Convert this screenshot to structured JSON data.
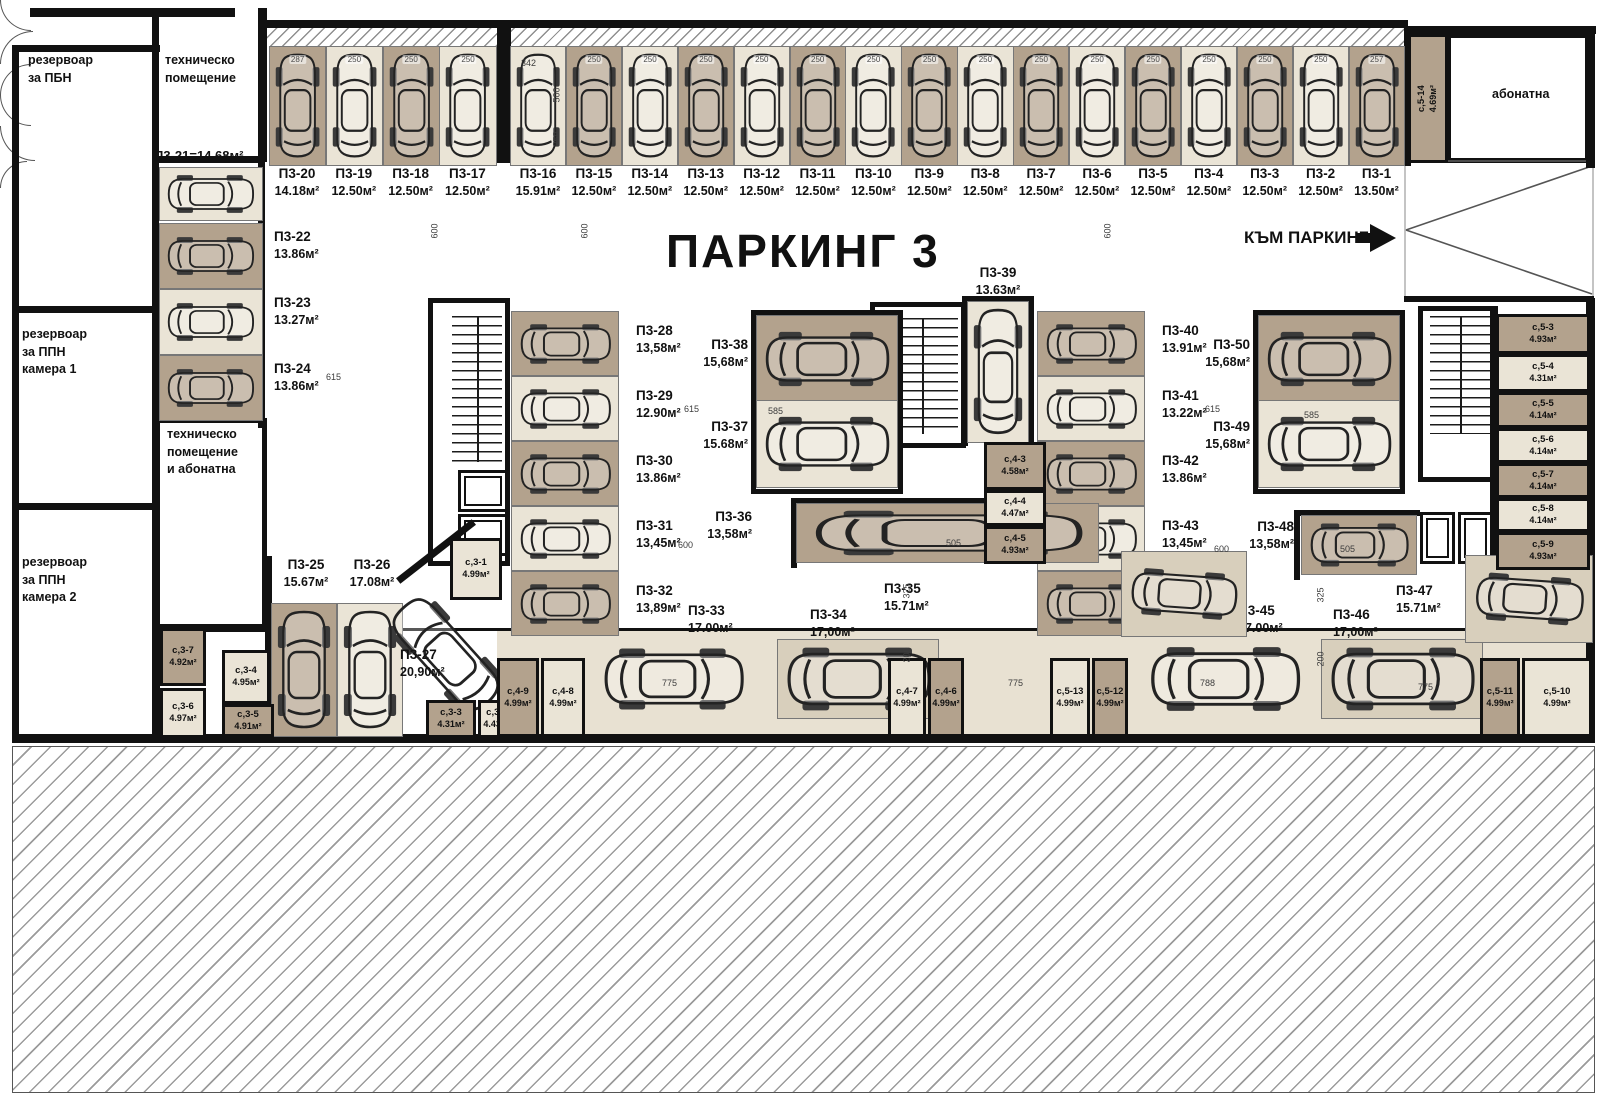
{
  "title": "ПАРКИНГ 3",
  "nav": {
    "to_parking": "КЪМ ПАРКИНГ 1"
  },
  "colors": {
    "wall": "#111111",
    "stall_tan": "#b3a28d",
    "stall_light": "#eae4d6",
    "hatch": "#8f8f8f"
  },
  "rooms": {
    "reservoir_pbn": "резервоар\nза ПБН",
    "reservoir_ppn1": "резервоар\nза ППН\nкамера 1",
    "reservoir_ppn2": "резервоар\nза ППН\nкамера 2",
    "tech_room": "техническо\nпомещение",
    "tech_room_abonatna": "техническо\nпомещение\nи абонатна",
    "abonatna": "абонатна"
  },
  "spots": {
    "p1": {
      "id": "П3-1",
      "area": "13.50м²",
      "dim": "257"
    },
    "p2": {
      "id": "П3-2",
      "area": "12.50м²",
      "dim": "250"
    },
    "p3": {
      "id": "П3-3",
      "area": "12.50м²",
      "dim": "250"
    },
    "p4": {
      "id": "П3-4",
      "area": "12.50м²",
      "dim": "250"
    },
    "p5": {
      "id": "П3-5",
      "area": "12.50м²",
      "dim": "250"
    },
    "p6": {
      "id": "П3-6",
      "area": "12.50м²",
      "dim": "250"
    },
    "p7": {
      "id": "П3-7",
      "area": "12.50м²",
      "dim": "250"
    },
    "p8": {
      "id": "П3-8",
      "area": "12.50м²",
      "dim": "250"
    },
    "p9": {
      "id": "П3-9",
      "area": "12.50м²",
      "dim": "250"
    },
    "p10": {
      "id": "П3-10",
      "area": "12.50м²",
      "dim": "250"
    },
    "p11": {
      "id": "П3-11",
      "area": "12.50м²",
      "dim": "250"
    },
    "p12": {
      "id": "П3-12",
      "area": "12.50м²",
      "dim": "250"
    },
    "p13": {
      "id": "П3-13",
      "area": "12.50м²",
      "dim": "250"
    },
    "p14": {
      "id": "П3-14",
      "area": "12.50м²",
      "dim": "250"
    },
    "p15": {
      "id": "П3-15",
      "area": "12.50м²",
      "dim": "250"
    },
    "p16": {
      "id": "П3-16",
      "area": "15.91м²"
    },
    "p17": {
      "id": "П3-17",
      "area": "12.50м²",
      "dim": "250"
    },
    "p18": {
      "id": "П3-18",
      "area": "12.50м²",
      "dim": "250"
    },
    "p19": {
      "id": "П3-19",
      "area": "12.50м²",
      "dim": "250"
    },
    "p20": {
      "id": "П3-20",
      "area": "14.18м²",
      "dim": "287"
    },
    "p21": {
      "id": "П3-21",
      "area": "14.68м²",
      "label": "П3-21=14.68м²"
    },
    "p22": {
      "id": "П3-22",
      "area": "13.86м²"
    },
    "p23": {
      "id": "П3-23",
      "area": "13.27м²"
    },
    "p24": {
      "id": "П3-24",
      "area": "13.86м²"
    },
    "p25": {
      "id": "П3-25",
      "area": "15.67м²"
    },
    "p26": {
      "id": "П3-26",
      "area": "17.08м²"
    },
    "p27": {
      "id": "П3-27",
      "area": "20,90м²"
    },
    "p28": {
      "id": "П3-28",
      "area": "13,58м²"
    },
    "p29": {
      "id": "П3-29",
      "area": "12.90м²"
    },
    "p30": {
      "id": "П3-30",
      "area": "13.86м²"
    },
    "p31": {
      "id": "П3-31",
      "area": "13,45м²"
    },
    "p32": {
      "id": "П3-32",
      "area": "13,89м²"
    },
    "p33": {
      "id": "П3-33",
      "area": "17.00м²"
    },
    "p34": {
      "id": "П3-34",
      "area": "17,00м²"
    },
    "p35": {
      "id": "П3-35",
      "area": "15.71м²"
    },
    "p36": {
      "id": "П3-36",
      "area": "13,58м²"
    },
    "p37": {
      "id": "П3-37",
      "area": "15.68м²"
    },
    "p38": {
      "id": "П3-38",
      "area": "15,68м²"
    },
    "p39": {
      "id": "П3-39",
      "area": "13.63м²"
    },
    "p40": {
      "id": "П3-40",
      "area": "13.91м²"
    },
    "p41": {
      "id": "П3-41",
      "area": "13.22м²"
    },
    "p42": {
      "id": "П3-42",
      "area": "13.86м²"
    },
    "p43": {
      "id": "П3-43",
      "area": "13,45м²"
    },
    "p44": {
      "id": "П3-44",
      "area": "13,89м²"
    },
    "p45": {
      "id": "П3-45",
      "area": "17.00м²"
    },
    "p46": {
      "id": "П3-46",
      "area": "17,00м²"
    },
    "p47": {
      "id": "П3-47",
      "area": "15.71м²"
    },
    "p48": {
      "id": "П3-48",
      "area": "13,58м²"
    },
    "p49": {
      "id": "П3-49",
      "area": "15,68м²"
    },
    "p50": {
      "id": "П3-50",
      "area": "15,68м²"
    }
  },
  "storages": {
    "s3_1": {
      "id": "с,3-1",
      "area": "4.99м²"
    },
    "s3_2": {
      "id": "с,3-2",
      "area": "4.43м²"
    },
    "s3_3": {
      "id": "с,3-3",
      "area": "4.31м²"
    },
    "s3_4": {
      "id": "с,3-4",
      "area": "4.95м²"
    },
    "s3_5": {
      "id": "с,3-5",
      "area": "4.91м²"
    },
    "s3_6": {
      "id": "с,3-6",
      "area": "4.97м²"
    },
    "s3_7": {
      "id": "с,3-7",
      "area": "4.92м²"
    },
    "s4_3": {
      "id": "с,4-3",
      "area": "4.58м²"
    },
    "s4_4": {
      "id": "с,4-4",
      "area": "4.47м²"
    },
    "s4_5": {
      "id": "с,4-5",
      "area": "4.93м²"
    },
    "s4_6": {
      "id": "с,4-6",
      "area": "4.99м²"
    },
    "s4_7": {
      "id": "с,4-7",
      "area": "4.99м²"
    },
    "s4_8": {
      "id": "с,4-8",
      "area": "4.99м²"
    },
    "s4_9": {
      "id": "с,4-9",
      "area": "4.99м²"
    },
    "s5_3": {
      "id": "с,5-3",
      "area": "4.93м²"
    },
    "s5_4": {
      "id": "с,5-4",
      "area": "4.31м²"
    },
    "s5_5": {
      "id": "с,5-5",
      "area": "4.14м²"
    },
    "s5_6": {
      "id": "с,5-6",
      "area": "4.14м²"
    },
    "s5_7": {
      "id": "с,5-7",
      "area": "4.14м²"
    },
    "s5_8": {
      "id": "с,5-8",
      "area": "4.14м²"
    },
    "s5_9": {
      "id": "с,5-9",
      "area": "4.93м²"
    },
    "s5_10": {
      "id": "с,5-10",
      "area": "4.99м²"
    },
    "s5_11": {
      "id": "с,5-11",
      "area": "4.99м²"
    },
    "s5_12": {
      "id": "с,5-12",
      "area": "4.99м²"
    },
    "s5_13": {
      "id": "с,5-13",
      "area": "4.99м²"
    },
    "s5_14": {
      "id": "с,5-14",
      "area": "4.69м²"
    }
  },
  "dims": [
    "342",
    "500",
    "250",
    "600",
    "600",
    "600",
    "615",
    "615",
    "615",
    "585",
    "585",
    "600",
    "600",
    "325",
    "325",
    "200",
    "200",
    "775",
    "775",
    "788",
    "775",
    "505",
    "505"
  ]
}
